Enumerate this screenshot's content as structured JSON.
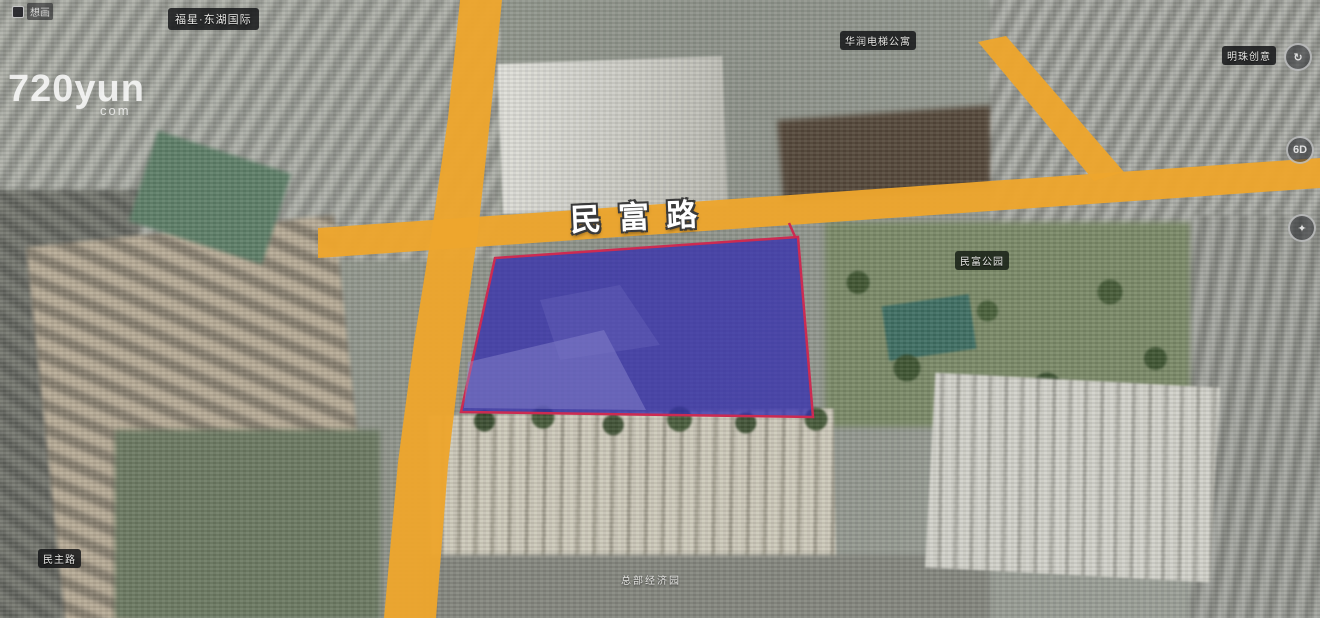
{
  "viewer": {
    "watermark": {
      "text": "想画"
    },
    "logo": {
      "number_word": "720yun",
      "suffix": "com"
    }
  },
  "overlay": {
    "road_label": "民富路",
    "colors": {
      "road": "#eda62d",
      "parcel_fill": "#322bb0",
      "parcel_border": "#cc2b52"
    },
    "poi_labels": [
      {
        "id": "top-left",
        "text": "福星·东湖国际"
      },
      {
        "id": "top-middle",
        "text": "华润电梯公寓"
      },
      {
        "id": "top-right",
        "text": "明珠创意"
      },
      {
        "id": "park",
        "text": "民富公园"
      },
      {
        "id": "bottom-left",
        "text": "民主路"
      },
      {
        "id": "bottom-center",
        "text": "总部经济园"
      }
    ],
    "hotspots": [
      {
        "glyph": "↻"
      },
      {
        "glyph": "6D"
      },
      {
        "glyph": "✦"
      }
    ]
  }
}
